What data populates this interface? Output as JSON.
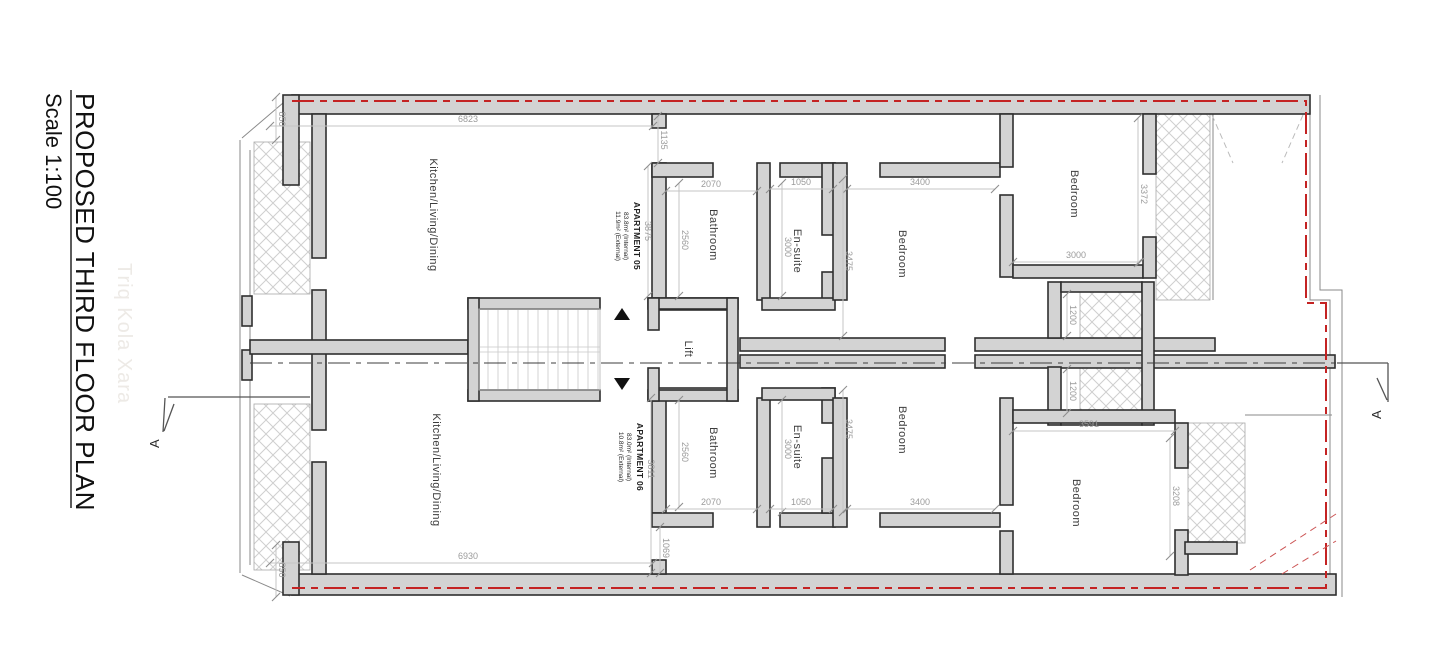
{
  "title": {
    "line1": "PROPOSED THIRD FLOOR PLAN",
    "line2": "Scale 1:100"
  },
  "watermark": "Triq Kola Xara",
  "section_marker": "A",
  "colors": {
    "boundary_red": "#c42323",
    "wall_fill": "#d3d3d3",
    "wall_stroke": "#2f2f2f",
    "dimension_gray": "#9b9b9b"
  },
  "apartments": [
    {
      "name": "APARTMENT 05",
      "internal": "83.8m² (Internal)",
      "external": "11.9m² (External)"
    },
    {
      "name": "APARTMENT 06",
      "internal": "83.0m² (Internal)",
      "external": "10.8m² (External)"
    }
  ],
  "rooms": {
    "kld": "Kitchen/Living/Dining",
    "bathroom": "Bathroom",
    "ensuite": "En-suite",
    "bedroom": "Bedroom",
    "lift": "Lift"
  },
  "dims": {
    "top_850": "850",
    "top_6823": "6823",
    "hall05_1135": "1135",
    "apt05_3875": "3875",
    "bath05_w_2070": "2070",
    "bath05_d_2560": "2560",
    "ens05_w_1050": "1050",
    "ens05_d_3000": "3000",
    "bed05_w_3400": "3400",
    "bed05_d_3475": "3475",
    "bedr05_d_3372": "3372",
    "bedr05_w_3000": "3000",
    "lobby05_1200": "1200",
    "lobby06_1200": "1200",
    "bed06_d_3475": "3475",
    "ens06_d_3000": "3000",
    "bath06_d_2560": "2560",
    "bath06_w_2070": "2070",
    "ens06_w_1050": "1050",
    "bed06_w_3400": "3400",
    "apt06_3811": "3811",
    "hall06_1069": "1069",
    "bedr06_w_3591": "3591",
    "bedr06_d_3208": "3208",
    "bottom_6930": "6930",
    "bottom_850": "850"
  }
}
